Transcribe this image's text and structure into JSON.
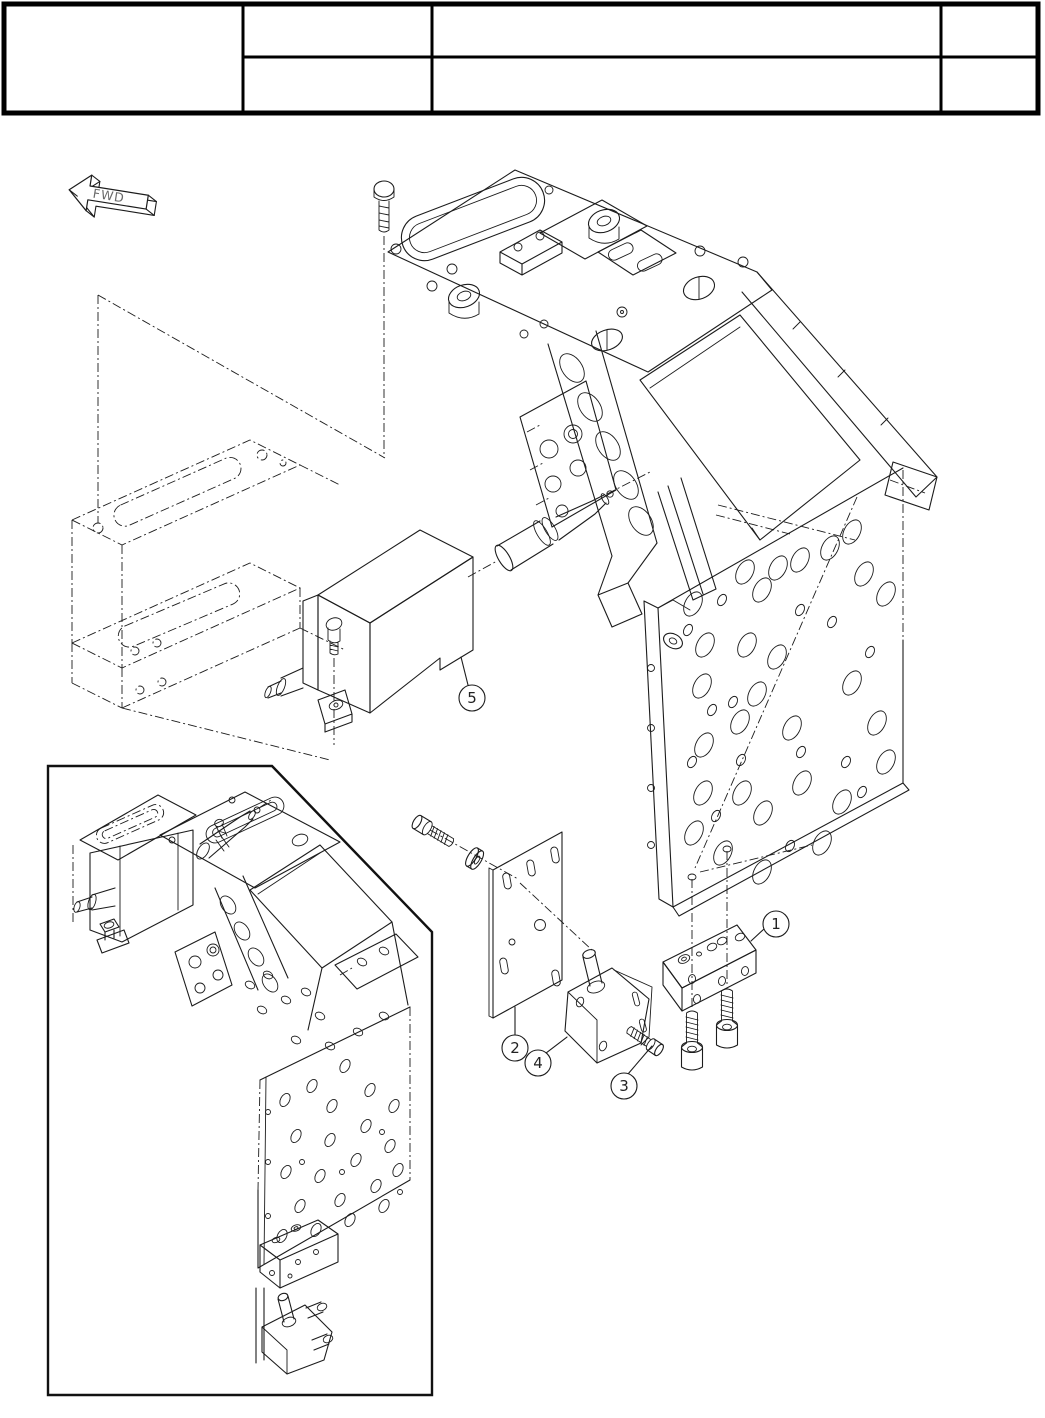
{
  "document": {
    "kind": "exploded-parts-diagram-page",
    "background": "#ffffff",
    "ink_color": "#1c1c1c"
  },
  "title_block": {
    "border_color": "#000000",
    "rows": 2,
    "cells": [
      {
        "id": "left-cell",
        "text": ""
      },
      {
        "id": "row1-col2",
        "text": ""
      },
      {
        "id": "row1-col3",
        "text": ""
      },
      {
        "id": "row1-col4",
        "text": ""
      },
      {
        "id": "row2-col2",
        "text": ""
      },
      {
        "id": "row2-col3",
        "text": ""
      },
      {
        "id": "row2-col4",
        "text": ""
      }
    ]
  },
  "direction_arrow": {
    "label": "FWD"
  },
  "callouts": [
    {
      "label": "1",
      "cx": 776,
      "cy": 924,
      "leader": [
        764,
        929,
        751,
        941
      ]
    },
    {
      "label": "2",
      "cx": 515,
      "cy": 1048,
      "leader": [
        515,
        1035,
        515,
        1007
      ]
    },
    {
      "label": "3",
      "cx": 624,
      "cy": 1086,
      "leader": [
        628,
        1074,
        652,
        1046
      ]
    },
    {
      "label": "4",
      "cx": 538,
      "cy": 1063,
      "leader": [
        546,
        1053,
        567,
        1037
      ]
    },
    {
      "label": "5",
      "cx": 472,
      "cy": 698,
      "leader": [
        468,
        685,
        461,
        657
      ]
    }
  ]
}
